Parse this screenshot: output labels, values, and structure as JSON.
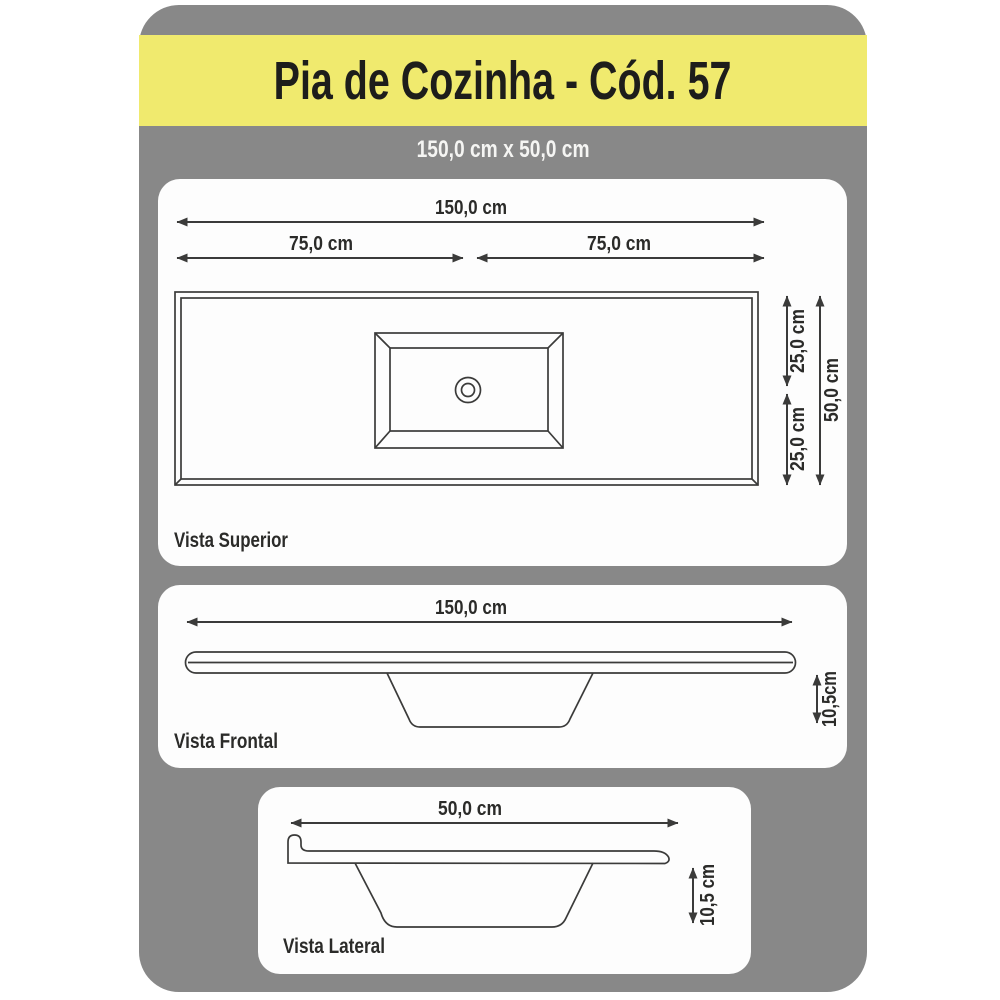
{
  "header": {
    "title": "Pia de Cozinha - Cód. 57",
    "subtitle": "150,0 cm x 50,0 cm"
  },
  "views": {
    "superior": {
      "label": "Vista Superior",
      "dims": {
        "total_width": "150,0 cm",
        "half_left": "75,0 cm",
        "half_right": "75,0 cm",
        "depth_top": "25,0 cm",
        "depth_bottom": "25,0 cm",
        "depth_total": "50,0 cm"
      }
    },
    "frontal": {
      "label": "Vista Frontal",
      "dims": {
        "width": "150,0 cm",
        "height": "10,5cm"
      }
    },
    "lateral": {
      "label": "Vista Lateral",
      "dims": {
        "depth": "50,0 cm",
        "height": "10,5 cm"
      }
    }
  },
  "colors": {
    "board_gray": "#888888",
    "band_yellow": "#f0ea6e",
    "line": "#3b3b3a",
    "panel_white": "#fdfdfd"
  }
}
